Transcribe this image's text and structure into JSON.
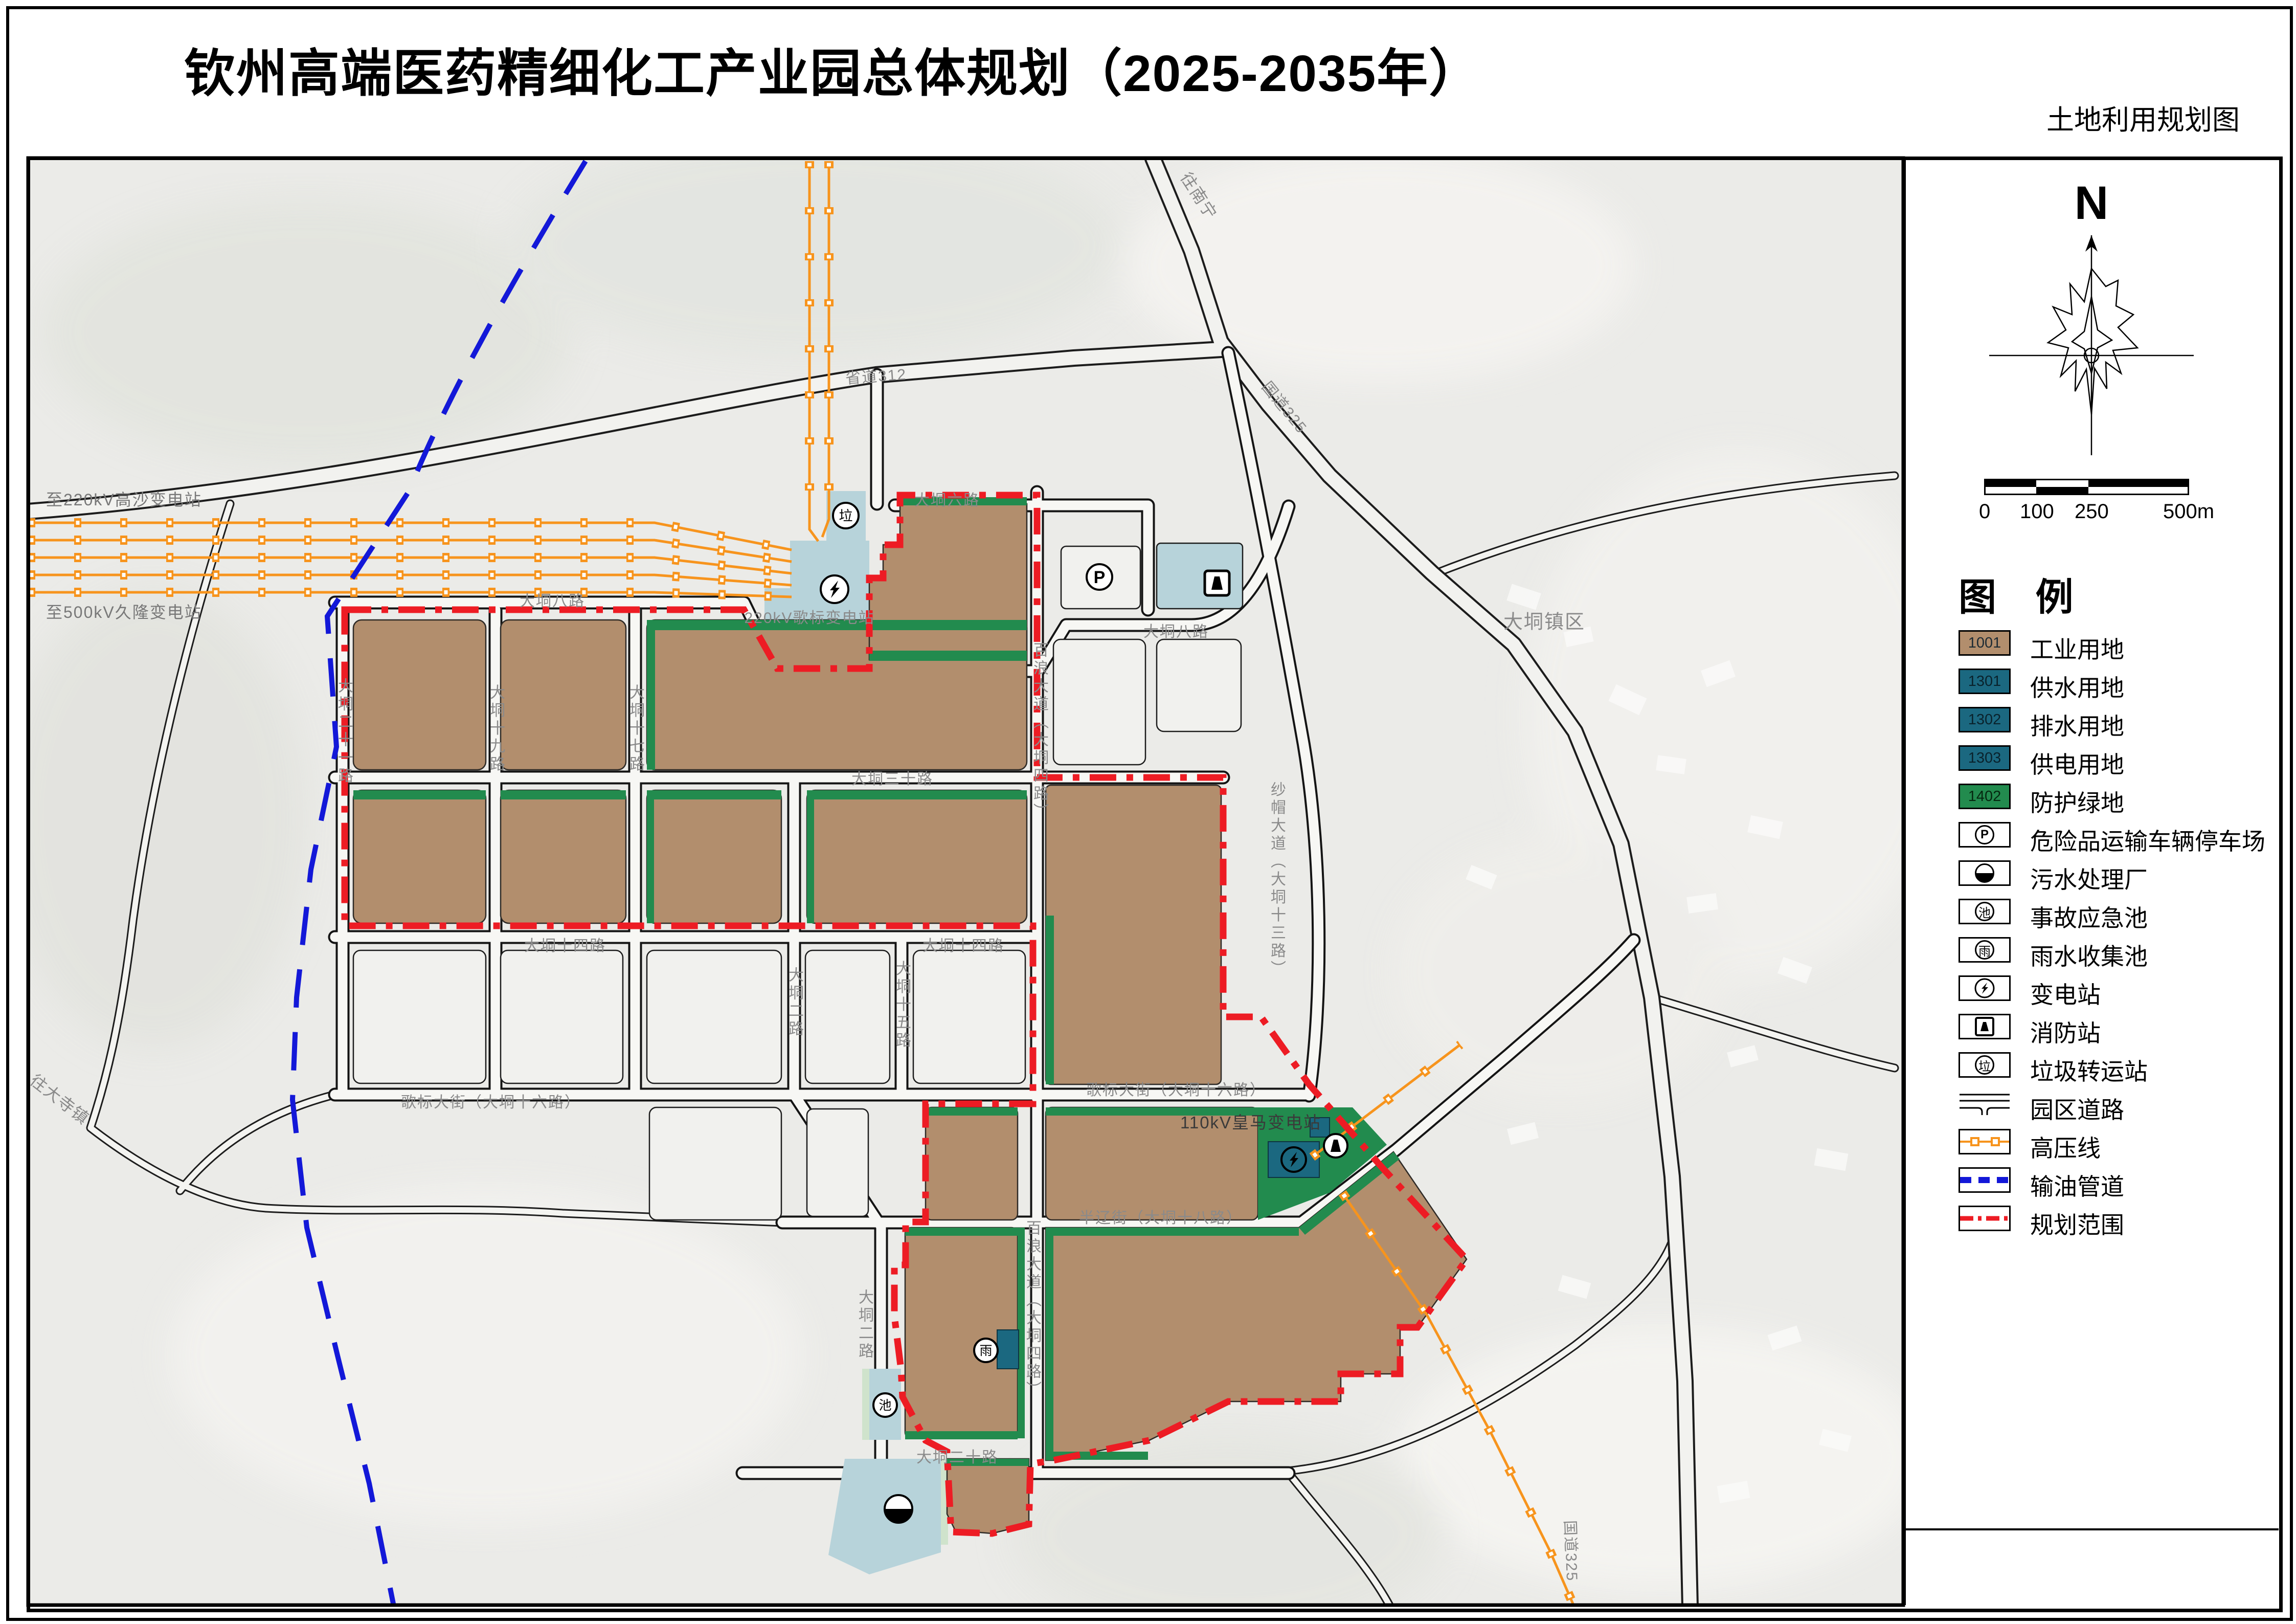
{
  "title": "钦州高端医药精细化工产业园总体规划（2025-2035年）",
  "subtitle": "土地利用规划图",
  "compass": {
    "north": "N"
  },
  "scale_bar": {
    "ticks": [
      "0",
      "100",
      "250",
      "500m"
    ]
  },
  "glyphs": {
    "parking": "P",
    "pool": "池",
    "rain": "雨",
    "garbage": "垃"
  },
  "legend": {
    "title": "图 例",
    "items": [
      {
        "type": "swatch",
        "code": "1001",
        "label": "工业用地",
        "color": "#b28e6d"
      },
      {
        "type": "swatch",
        "code": "1301",
        "label": "供水用地",
        "color": "#1b6880"
      },
      {
        "type": "swatch",
        "code": "1302",
        "label": "排水用地",
        "color": "#1b6880"
      },
      {
        "type": "swatch",
        "code": "1303",
        "label": "供电用地",
        "color": "#1b6880"
      },
      {
        "type": "swatch",
        "code": "1402",
        "label": "防护绿地",
        "color": "#228b4e"
      },
      {
        "type": "icon",
        "icon": "parking-circle",
        "label": "危险品运输车辆停车场"
      },
      {
        "type": "icon",
        "icon": "half-circle",
        "label": "污水处理厂"
      },
      {
        "type": "icon",
        "icon": "pool-circle",
        "label": "事故应急池"
      },
      {
        "type": "icon",
        "icon": "rain-circle",
        "label": "雨水收集池"
      },
      {
        "type": "icon",
        "icon": "bolt-circle",
        "label": "变电站"
      },
      {
        "type": "icon",
        "icon": "fire-square",
        "label": "消防站"
      },
      {
        "type": "icon",
        "icon": "garbage-circle",
        "label": "垃圾转运站"
      },
      {
        "type": "icon",
        "icon": "road-symbol",
        "label": "园区道路"
      },
      {
        "type": "icon",
        "icon": "hv-line",
        "label": "高压线"
      },
      {
        "type": "icon",
        "icon": "pipeline",
        "label": "输油管道"
      },
      {
        "type": "icon",
        "icon": "boundary",
        "label": "规划范围"
      }
    ]
  },
  "map": {
    "labels": [
      {
        "text": "至220kV高沙变电站"
      },
      {
        "text": "至500kV久隆变电站"
      },
      {
        "text": "省道312"
      },
      {
        "text": "往南宁"
      },
      {
        "text": "国道325"
      },
      {
        "text": "大垌镇区"
      },
      {
        "text": "国道325"
      },
      {
        "text": "往大寺镇"
      },
      {
        "text": "220kV歌标变电站"
      },
      {
        "text": "110kV皇马变电站"
      },
      {
        "text": "大垌六路"
      },
      {
        "text": "大垌八路"
      },
      {
        "text": "大垌八路"
      },
      {
        "text": "大垌三十路"
      },
      {
        "text": "大垌十四路"
      },
      {
        "text": "大垌十四路"
      },
      {
        "text": "歌标大街（大垌十六路）"
      },
      {
        "text": "歌标大街（大垌十六路）"
      },
      {
        "text": "半辽街（大垌十八路）"
      },
      {
        "text": "大垌二十路"
      },
      {
        "text": "大垌二十一路"
      },
      {
        "text": "大垌十九路"
      },
      {
        "text": "大垌十七路"
      },
      {
        "text": "大垌二路"
      },
      {
        "text": "大垌十五路"
      },
      {
        "text": "百浪大道（大垌四路）"
      },
      {
        "text": "百浪大道（大垌四路）"
      },
      {
        "text": "大垌二路"
      },
      {
        "text": "纱帽大道（大垌十三路）"
      }
    ]
  },
  "colors": {
    "industrial": "#b28e6d",
    "utility_blue": "#1b6880",
    "protective_green": "#228b4e",
    "facility_lightblue": "#b7d3da",
    "boundary_red": "#ed1c24",
    "hv_orange": "#f7941d",
    "pipeline_blue": "#1318d8"
  }
}
